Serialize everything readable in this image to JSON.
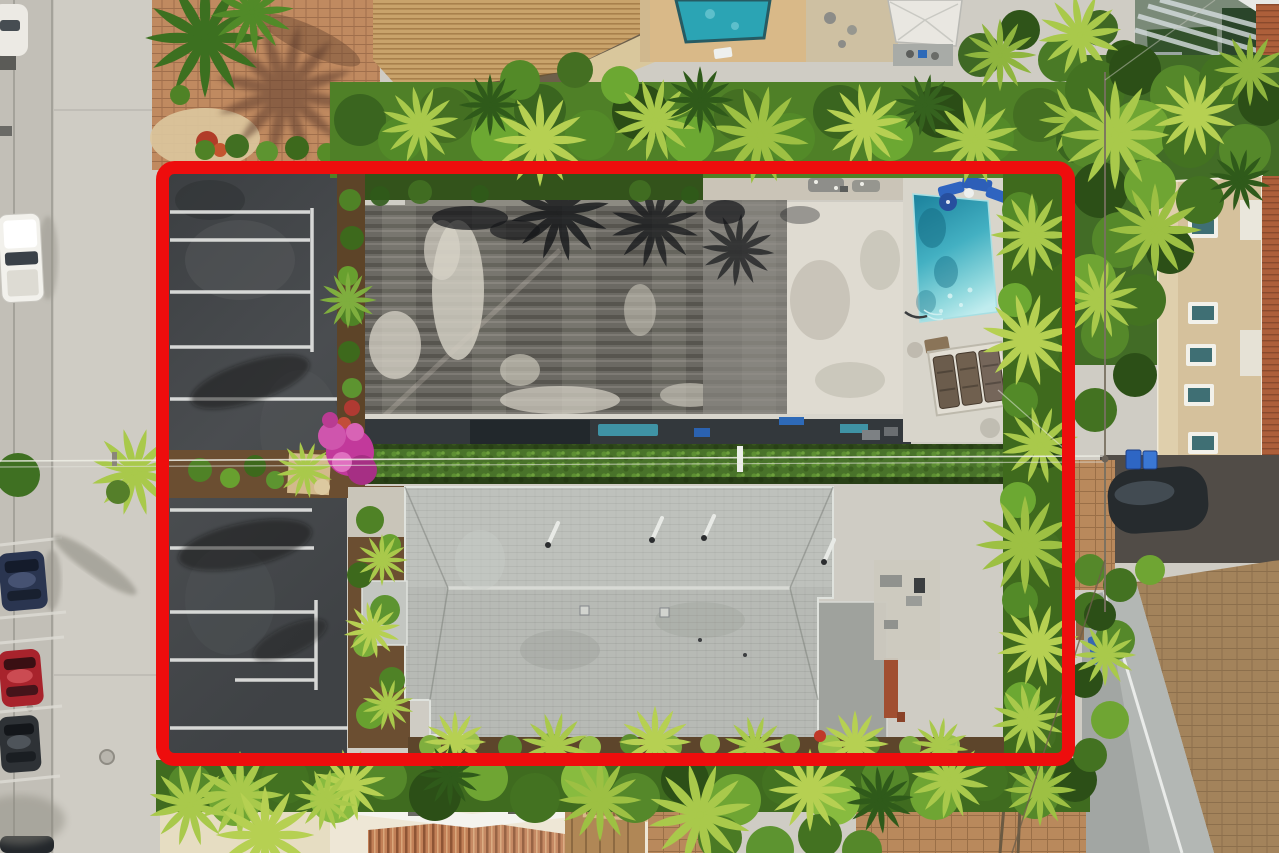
{
  "meta": {
    "type": "aerial drone photograph",
    "description": "Top-down aerial photo of a coastal multifamily property outlined with a thick red boundary. Inside the boundary: a striped asphalt parking lot, a weathered dark flat-roof building, a light gray gable-roof building, a turquoise swimming pool with deck loungers, a long privacy hedge and dense tropical palms. Outside: a concrete street with angle-parked cars on the left, neighboring homes, a neighbor pool, paver driveways and lush canopy all around.",
    "camera": "top-down"
  },
  "boundary": {
    "label": "property boundary",
    "shape": "rounded rectangle",
    "stroke_color": "#ee0d0d",
    "stroke_width_px": 13,
    "left_px": 156,
    "top_px": 161,
    "width_px": 919,
    "height_px": 605
  },
  "scene": {
    "inside_boundary": [
      "asphalt parking lot with white striped stalls",
      "landscaped median with pink bougainvillea",
      "weathered dark flat-roof building (north)",
      "light gray shingle gable-roof building (south)",
      "turquoise swimming pool",
      "pool deck with blue chairs and three sun loungers",
      "long privacy hedge with overhead utility lines",
      "tropical palm border along east edge"
    ],
    "outside_boundary": [
      "concrete street with angle-parked cars (white, dark blue, red, dark gray)",
      "red-brown paver drive with palms (top left)",
      "neighbor pool and tan tile-roof house (top)",
      "modern glass house (top right)",
      "cream two-story house with terracotta roof (right)",
      "tarp-covered car and blue bins (right)",
      "brown paver driveways (bottom right)",
      "rust corrugated-roof cottage (bottom center)"
    ]
  },
  "counts": {
    "buildings_inside_boundary": 2,
    "parked_cars_visible_left": 4,
    "sun_loungers": 3,
    "parking_stall_rows": 2
  },
  "palette": {
    "boundary-red": "#ee0d0d",
    "road-concrete": "#cfccc4",
    "asphalt": "#45484b",
    "stripe-white": "#e6e7e5",
    "north-roof-dark": "#6a6862",
    "north-roof-white": "#dfdbd1",
    "south-roof-gray": "#b7bab5",
    "pool-teal": "#3fadc0",
    "pool-deck": "#d8d5cb",
    "hedge-green": "#49732a",
    "canopy-green": "#4f8027",
    "palm-lime": "#a9c94b",
    "paver-tan": "#bd8a63",
    "driveway-brown": "#a08057",
    "mulch-brown": "#6b4e31",
    "bougainvillea-pink": "#c2399b"
  }
}
